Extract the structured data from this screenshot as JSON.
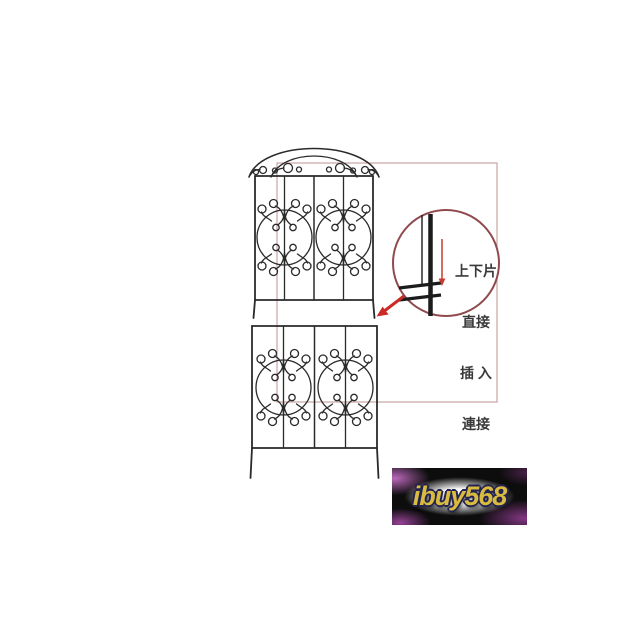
{
  "page": {
    "background_color": "#ffffff"
  },
  "diagram": {
    "line_color": "#2a2a2a",
    "highlight_box_color": "#c7a3a3",
    "parts": {
      "upper_panel": "arched-trellis-panel",
      "lower_panel": "straight-trellis-panel",
      "connection": "post-insert-joint"
    },
    "callout": {
      "circle_color": "#8f4a4e",
      "arrow_color": "#cc2a26",
      "text_color": "#3a3a3a",
      "lines": [
        "上下片",
        "直接",
        "插 入",
        "連接"
      ]
    }
  },
  "watermark": {
    "text": "ibuy568",
    "text_color": "#d9bb3f",
    "outline_color": "#232350",
    "glow_color": "#ffffff",
    "accent_color": "#a050a0",
    "background_color": "#0d0d0d"
  }
}
